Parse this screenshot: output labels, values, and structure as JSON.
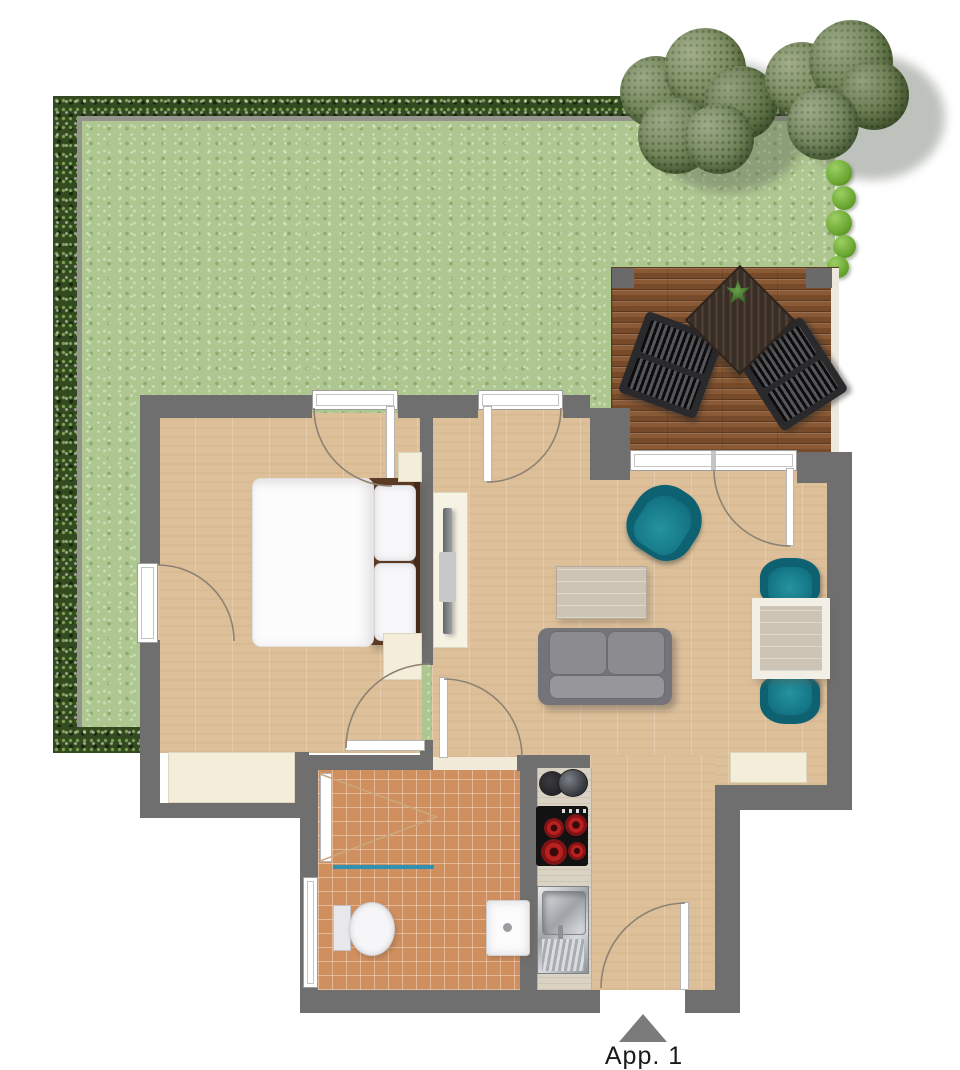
{
  "labels": {
    "entry": "App. 1"
  },
  "palette": {
    "wall": "#6f6f6f",
    "wood_floor": "#ddc09a",
    "bathroom_tile": "#d08f5e",
    "terrace_wood": "#8a5a36",
    "lawn": "#aec690",
    "hedge": "#33491f",
    "teal_accent": "#17808f",
    "cream_furniture": "#f3edda",
    "sofa_gray": "#85858a",
    "door_frame_white": "#ffffff"
  },
  "icons": [
    {
      "name": "entry-arrow-icon",
      "meaning": "apartment entrance direction marker"
    },
    {
      "name": "plant-icon",
      "meaning": "plant on terrace table"
    }
  ],
  "rooms": [
    "garden",
    "terrace",
    "bedroom",
    "hall",
    "living-room",
    "bathroom",
    "kitchen"
  ],
  "furniture": [
    "double-bed",
    "wardrobe",
    "tv-lowboard",
    "sofa",
    "coffee-table",
    "armchair",
    "dining-table",
    "dining-chair",
    "terrace-table",
    "terrace-chair",
    "shower",
    "toilet",
    "washbasin",
    "cooktop",
    "kitchen-sink",
    "coffee-machine"
  ]
}
